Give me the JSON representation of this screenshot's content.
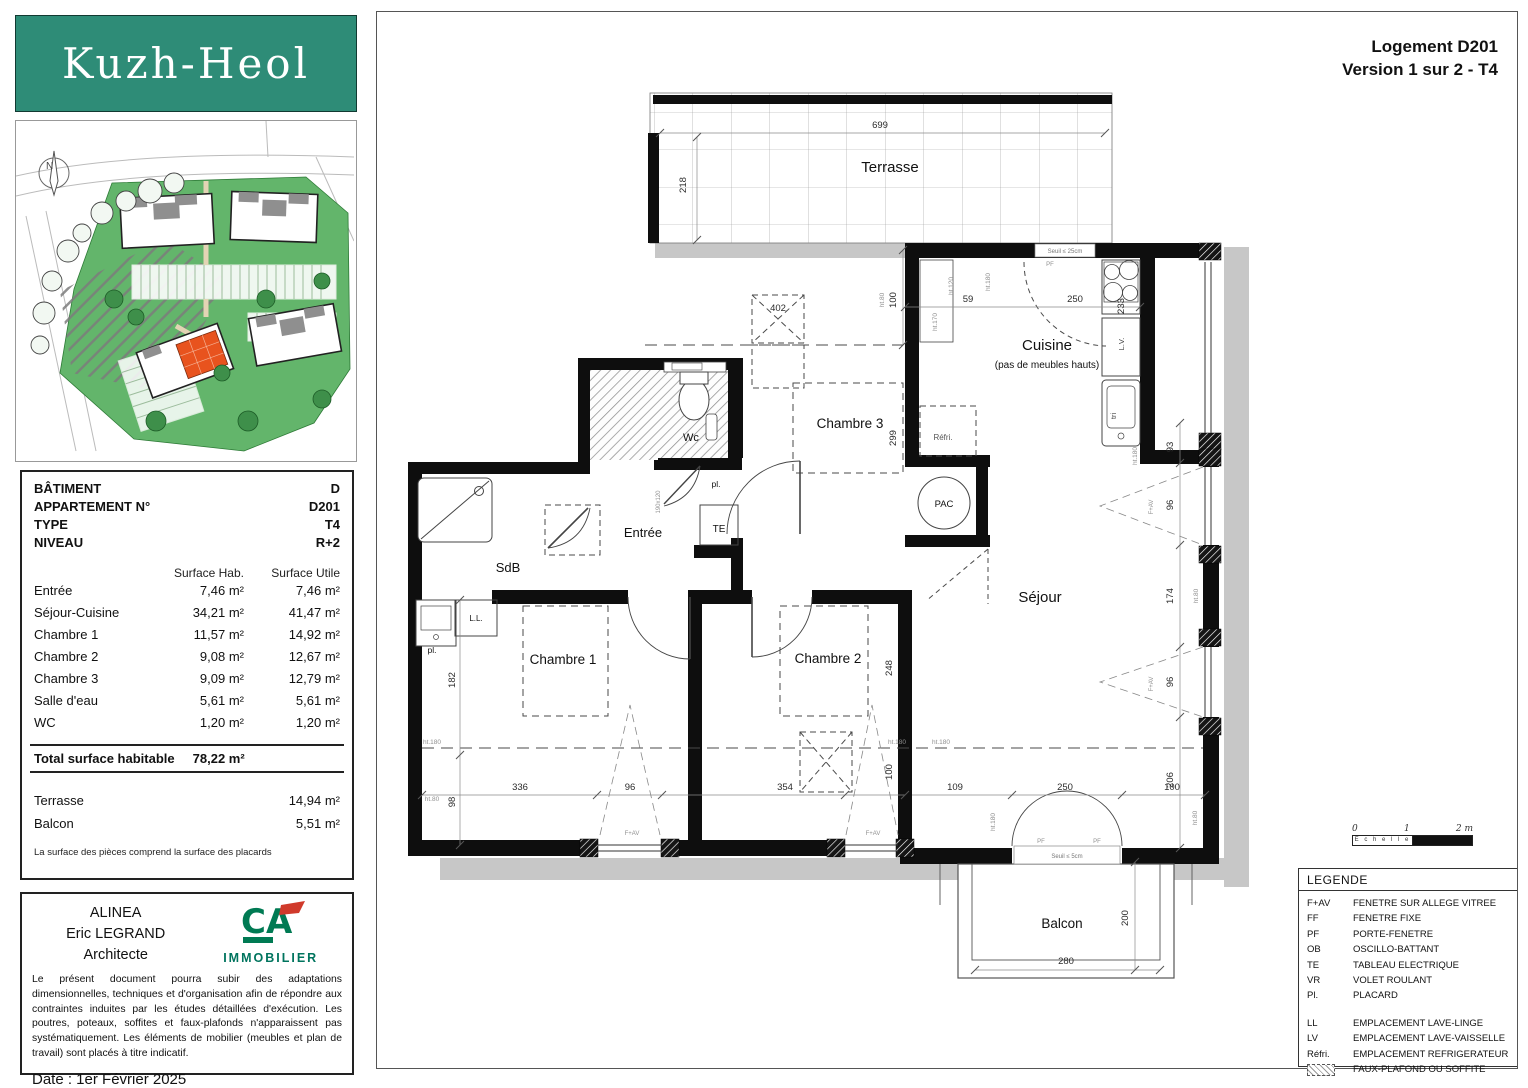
{
  "logo": {
    "text": "Kuzh-Heol"
  },
  "compass": {
    "label": "N"
  },
  "title_block": {
    "line1": "Logement D201",
    "line2": "Version 1 sur 2 - T4"
  },
  "info_panel": {
    "fields": [
      {
        "label": "BÂTIMENT",
        "value": "D"
      },
      {
        "label": "APPARTEMENT N°",
        "value": "D201"
      },
      {
        "label": "TYPE",
        "value": "T4"
      },
      {
        "label": "NIVEAU",
        "value": "R+2"
      }
    ],
    "col_headers": [
      "Surface Hab.",
      "Surface Utile"
    ],
    "rooms": [
      {
        "name": "Entrée",
        "hab": "7,46 m²",
        "utile": "7,46 m²"
      },
      {
        "name": "Séjour-Cuisine",
        "hab": "34,21 m²",
        "utile": "41,47 m²"
      },
      {
        "name": "Chambre 1",
        "hab": "11,57 m²",
        "utile": "14,92 m²"
      },
      {
        "name": "Chambre 2",
        "hab": "9,08 m²",
        "utile": "12,67 m²"
      },
      {
        "name": "Chambre 3",
        "hab": "9,09 m²",
        "utile": "12,79 m²"
      },
      {
        "name": "Salle d'eau",
        "hab": "5,61 m²",
        "utile": "5,61 m²"
      },
      {
        "name": "WC",
        "hab": "1,20 m²",
        "utile": "1,20 m²"
      }
    ],
    "total_label": "Total surface habitable",
    "total_value": "78,22 m²",
    "extras": [
      {
        "name": "Terrasse",
        "value": "14,94 m²"
      },
      {
        "name": "Balcon",
        "value": "5,51 m²"
      }
    ],
    "footnote": "La surface des pièces comprend la surface des placards"
  },
  "architect_block": {
    "firm": "ALINEA",
    "architect": "Eric LEGRAND",
    "role": "Architecte",
    "brand_initials": "CA",
    "brand": "IMMOBILIER",
    "disclaimer": "Le présent document pourra subir des adaptations dimensionnelles, techniques et d'organisation afin de répondre aux contraintes induites par les études détaillées d'exécution. Les poutres, poteaux, soffites et faux-plafonds n'apparaissent pas systématiquement. Les éléments de mobilier (meubles et plan de travail) sont placés à titre indicatif.",
    "date": "Date : 1er Février 2025"
  },
  "scale_bar": {
    "t0": "0",
    "t1": "1",
    "t2": "2 m",
    "label": "E c h e l l e"
  },
  "legend": {
    "title": "LEGENDE",
    "entries": [
      {
        "abbr": "F+AV",
        "label": "FENETRE SUR ALLEGE VITREE"
      },
      {
        "abbr": "FF",
        "label": "FENETRE FIXE"
      },
      {
        "abbr": "PF",
        "label": "PORTE-FENETRE"
      },
      {
        "abbr": "OB",
        "label": "OSCILLO-BATTANT"
      },
      {
        "abbr": "TE",
        "label": "TABLEAU ELECTRIQUE"
      },
      {
        "abbr": "VR",
        "label": "VOLET ROULANT"
      },
      {
        "abbr": "Pl.",
        "label": "PLACARD"
      },
      {
        "abbr": "LL",
        "label": "EMPLACEMENT LAVE-LINGE"
      },
      {
        "abbr": "LV",
        "label": "EMPLACEMENT LAVE-VAISSELLE"
      },
      {
        "abbr": "Réfri.",
        "label": "EMPLACEMENT REFRIGERATEUR"
      },
      {
        "abbr": "",
        "icon": "faux-plafond-hatch",
        "label": "FAUX-PLAFOND OU SOFFITE"
      }
    ]
  },
  "floor_plan": {
    "rooms": [
      {
        "id": "terrasse",
        "label": "Terrasse",
        "x": 890,
        "y": 172,
        "size": 15
      },
      {
        "id": "cuisine",
        "label": "Cuisine",
        "x": 1047,
        "y": 350,
        "size": 15
      },
      {
        "id": "cuisine-note",
        "label": "(pas de meubles hauts)",
        "x": 1047,
        "y": 368,
        "size": 10
      },
      {
        "id": "chambre3",
        "label": "Chambre 3",
        "x": 850,
        "y": 428,
        "size": 13.5
      },
      {
        "id": "sejour",
        "label": "Séjour",
        "x": 1040,
        "y": 602,
        "size": 15
      },
      {
        "id": "chambre1",
        "label": "Chambre 1",
        "x": 563,
        "y": 664,
        "size": 13.5
      },
      {
        "id": "chambre2",
        "label": "Chambre 2",
        "x": 828,
        "y": 663,
        "size": 13.5
      },
      {
        "id": "sdb",
        "label": "SdB",
        "x": 508,
        "y": 572,
        "size": 13
      },
      {
        "id": "entree",
        "label": "Entrée",
        "x": 643,
        "y": 537,
        "size": 13
      },
      {
        "id": "wc",
        "label": "Wc",
        "x": 691,
        "y": 441,
        "size": 11
      },
      {
        "id": "balcon",
        "label": "Balcon",
        "x": 1062,
        "y": 928,
        "size": 13.5
      },
      {
        "id": "pac",
        "label": "PAC",
        "x": 944,
        "y": 507,
        "size": 9.5
      },
      {
        "id": "refri",
        "label": "Réfri.",
        "x": 943,
        "y": 440,
        "size": 8,
        "color": "#555"
      },
      {
        "id": "te",
        "label": "TE",
        "x": 719,
        "y": 532,
        "size": 10
      },
      {
        "id": "pl-entree",
        "label": "pl.",
        "x": 716,
        "y": 487,
        "size": 8.5
      },
      {
        "id": "pl-chambre1",
        "label": "pl.",
        "x": 432,
        "y": 653,
        "size": 8.5
      },
      {
        "id": "ll",
        "label": "L.L.",
        "x": 476,
        "y": 621,
        "size": 8
      }
    ],
    "dimensions": [
      {
        "v": "699",
        "x": 880,
        "y": 128
      },
      {
        "v": "218",
        "x": 686,
        "y": 185,
        "rot": -90
      },
      {
        "v": "402",
        "x": 778,
        "y": 311
      },
      {
        "v": "100",
        "x": 896,
        "y": 300,
        "rot": -90
      },
      {
        "v": "59",
        "x": 968,
        "y": 302
      },
      {
        "v": "250",
        "x": 1075,
        "y": 302
      },
      {
        "v": "233",
        "x": 1124,
        "y": 306,
        "rot": -90
      },
      {
        "v": "299",
        "x": 896,
        "y": 438,
        "rot": -90
      },
      {
        "v": "93",
        "x": 1173,
        "y": 447,
        "rot": -90
      },
      {
        "v": "96",
        "x": 1173,
        "y": 505,
        "rot": -90
      },
      {
        "v": "174",
        "x": 1173,
        "y": 596,
        "rot": -90
      },
      {
        "v": "96",
        "x": 1173,
        "y": 682,
        "rot": -90
      },
      {
        "v": "206",
        "x": 1173,
        "y": 780,
        "rot": -90
      },
      {
        "v": "182",
        "x": 455,
        "y": 680,
        "rot": -90
      },
      {
        "v": "98",
        "x": 455,
        "y": 802,
        "rot": -90
      },
      {
        "v": "336",
        "x": 520,
        "y": 790
      },
      {
        "v": "96",
        "x": 630,
        "y": 790
      },
      {
        "v": "354",
        "x": 785,
        "y": 790
      },
      {
        "v": "248",
        "x": 892,
        "y": 668,
        "rot": -90
      },
      {
        "v": "100",
        "x": 892,
        "y": 772,
        "rot": -90
      },
      {
        "v": "109",
        "x": 955,
        "y": 790
      },
      {
        "v": "250",
        "x": 1065,
        "y": 790
      },
      {
        "v": "100",
        "x": 1172,
        "y": 790
      },
      {
        "v": "200",
        "x": 1128,
        "y": 918,
        "rot": -90
      },
      {
        "v": "280",
        "x": 1066,
        "y": 964
      }
    ],
    "notes": [
      {
        "t": "Seuil ≤ 25cm",
        "x": 1065,
        "y": 253,
        "s": 6,
        "c": "#777"
      },
      {
        "t": "Seuil ≤ 5cm",
        "x": 1067,
        "y": 858,
        "s": 6,
        "c": "#777"
      },
      {
        "t": "PF",
        "x": 1050,
        "y": 266,
        "s": 6
      },
      {
        "t": "PF",
        "x": 1041,
        "y": 843,
        "s": 6
      },
      {
        "t": "PF",
        "x": 1097,
        "y": 843,
        "s": 6
      },
      {
        "t": "F+AV",
        "x": 1153,
        "y": 507,
        "s": 6,
        "rot": -90
      },
      {
        "t": "F+AV",
        "x": 1153,
        "y": 684,
        "s": 6,
        "rot": -90
      },
      {
        "t": "F+AV",
        "x": 632,
        "y": 835,
        "s": 6
      },
      {
        "t": "F+AV",
        "x": 873,
        "y": 835,
        "s": 6
      },
      {
        "t": "L.V.",
        "x": 1124,
        "y": 344,
        "s": 7.5,
        "rot": -90,
        "c": "#444"
      },
      {
        "t": "tri",
        "x": 1116,
        "y": 416,
        "s": 7.5,
        "rot": -90,
        "c": "#444"
      },
      {
        "t": "ht.120",
        "x": 953,
        "y": 286,
        "s": 6.5,
        "rot": -90
      },
      {
        "t": "ht.180",
        "x": 990,
        "y": 282,
        "s": 6.5,
        "rot": -90
      },
      {
        "t": "ht.80",
        "x": 884,
        "y": 300,
        "s": 6.5,
        "rot": -90
      },
      {
        "t": "ht.170",
        "x": 937,
        "y": 322,
        "s": 6.5,
        "rot": -90
      },
      {
        "t": "ht.180",
        "x": 1137,
        "y": 456,
        "s": 6.5,
        "rot": -90
      },
      {
        "t": "ht.80",
        "x": 1198,
        "y": 596,
        "s": 6.5,
        "rot": -90
      },
      {
        "t": "ht.180",
        "x": 432,
        "y": 744,
        "s": 6.5
      },
      {
        "t": "ht.80",
        "x": 432,
        "y": 801,
        "s": 6.5
      },
      {
        "t": "ht.180",
        "x": 897,
        "y": 744,
        "s": 6.5
      },
      {
        "t": "ht.180",
        "x": 941,
        "y": 744,
        "s": 6.5
      },
      {
        "t": "ht.180",
        "x": 995,
        "y": 822,
        "s": 6.5,
        "rot": -90
      },
      {
        "t": "ht.80",
        "x": 1197,
        "y": 818,
        "s": 6.5,
        "rot": -90
      },
      {
        "t": "190x120",
        "x": 660,
        "y": 502,
        "s": 6,
        "rot": -90
      }
    ]
  }
}
